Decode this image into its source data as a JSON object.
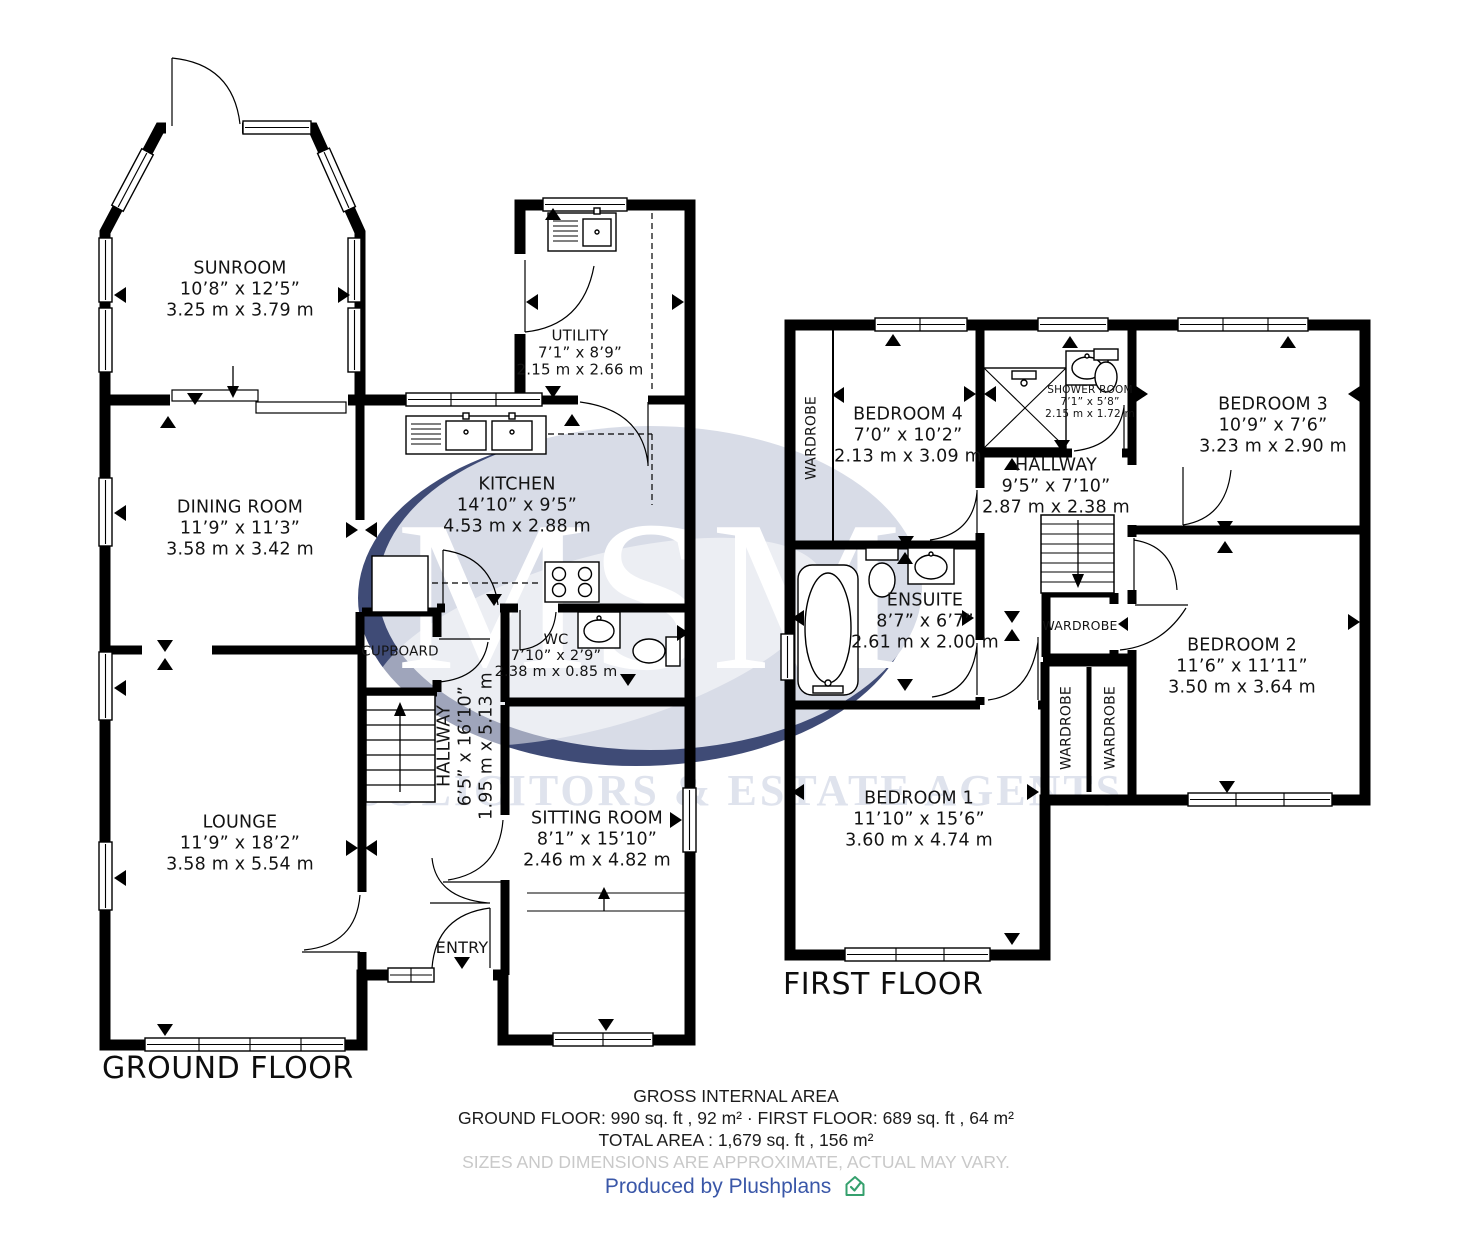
{
  "watermark": {
    "brand": "MSM",
    "subtitle": "SOLICITORS & ESTATE AGENTS"
  },
  "colors": {
    "wall": "#000000",
    "accent_blue": "#3a57a8",
    "brand_green": "#35a06d",
    "watermark_fill": "#d8dce7",
    "muted_text": "#c9c9c9"
  },
  "floors": {
    "ground": {
      "label": "GROUND FLOOR",
      "rooms": {
        "sunroom": {
          "name": "SUNROOM",
          "imperial": "10’8” x 12’5”",
          "metric": "3.25 m x 3.79 m"
        },
        "dining": {
          "name": "DINING ROOM",
          "imperial": "11’9” x 11’3”",
          "metric": "3.58 m x 3.42 m"
        },
        "kitchen": {
          "name": "KITCHEN",
          "imperial": "14’10” x 9’5”",
          "metric": "4.53 m x 2.88 m"
        },
        "utility": {
          "name": "UTILITY",
          "imperial": "7’1” x 8’9”",
          "metric": "2.15 m x 2.66 m"
        },
        "wc": {
          "name": "WC",
          "imperial": "7’10” x 2’9”",
          "metric": "2.38 m x 0.85 m"
        },
        "cupboard": {
          "name": "CUPBOARD"
        },
        "hallway": {
          "name": "HALLWAY",
          "imperial": "6’5” x 16’10”",
          "metric": "1.95 m x 5.13 m"
        },
        "lounge": {
          "name": "LOUNGE",
          "imperial": "11’9” x 18’2”",
          "metric": "3.58 m x 5.54 m"
        },
        "sitting": {
          "name": "SITTING ROOM",
          "imperial": "8’1” x 15’10”",
          "metric": "2.46 m x 4.82 m"
        },
        "entry": {
          "name": "ENTRY"
        }
      }
    },
    "first": {
      "label": "FIRST FLOOR",
      "wardrobe_label": "WARDROBE",
      "rooms": {
        "bedroom4": {
          "name": "BEDROOM 4",
          "imperial": "7’0” x 10’2”",
          "metric": "2.13 m x 3.09 m"
        },
        "shower": {
          "name": "SHOWER ROOM",
          "imperial": "7’1” x 5’8”",
          "metric": "2.15 m x 1.72 m"
        },
        "bedroom3": {
          "name": "BEDROOM 3",
          "imperial": "10’9” x 7’6”",
          "metric": "3.23 m x 2.90 m"
        },
        "hallway": {
          "name": "HALLWAY",
          "imperial": "9’5” x 7’10”",
          "metric": "2.87 m x 2.38 m"
        },
        "ensuite": {
          "name": "ENSUITE",
          "imperial": "8’7” x 6’7”",
          "metric": "2.61 m x 2.00 m"
        },
        "bedroom2": {
          "name": "BEDROOM 2",
          "imperial": "11’6” x 11’11”",
          "metric": "3.50 m x 3.64 m"
        },
        "bedroom1": {
          "name": "BEDROOM 1",
          "imperial": "11’10” x 15’6”",
          "metric": "3.60 m x 4.74 m"
        }
      }
    }
  },
  "footer": {
    "gross_title": "GROSS INTERNAL AREA",
    "areas_line": "GROUND FLOOR: 990 sq. ft , 92 m² · FIRST FLOOR: 689 sq. ft , 64 m²",
    "total_line": "TOTAL AREA : 1,679 sq. ft , 156 m²",
    "disclaimer": "SIZES AND DIMENSIONS ARE APPROXIMATE, ACTUAL MAY VARY.",
    "produced_by": "Produced by Plushplans"
  }
}
